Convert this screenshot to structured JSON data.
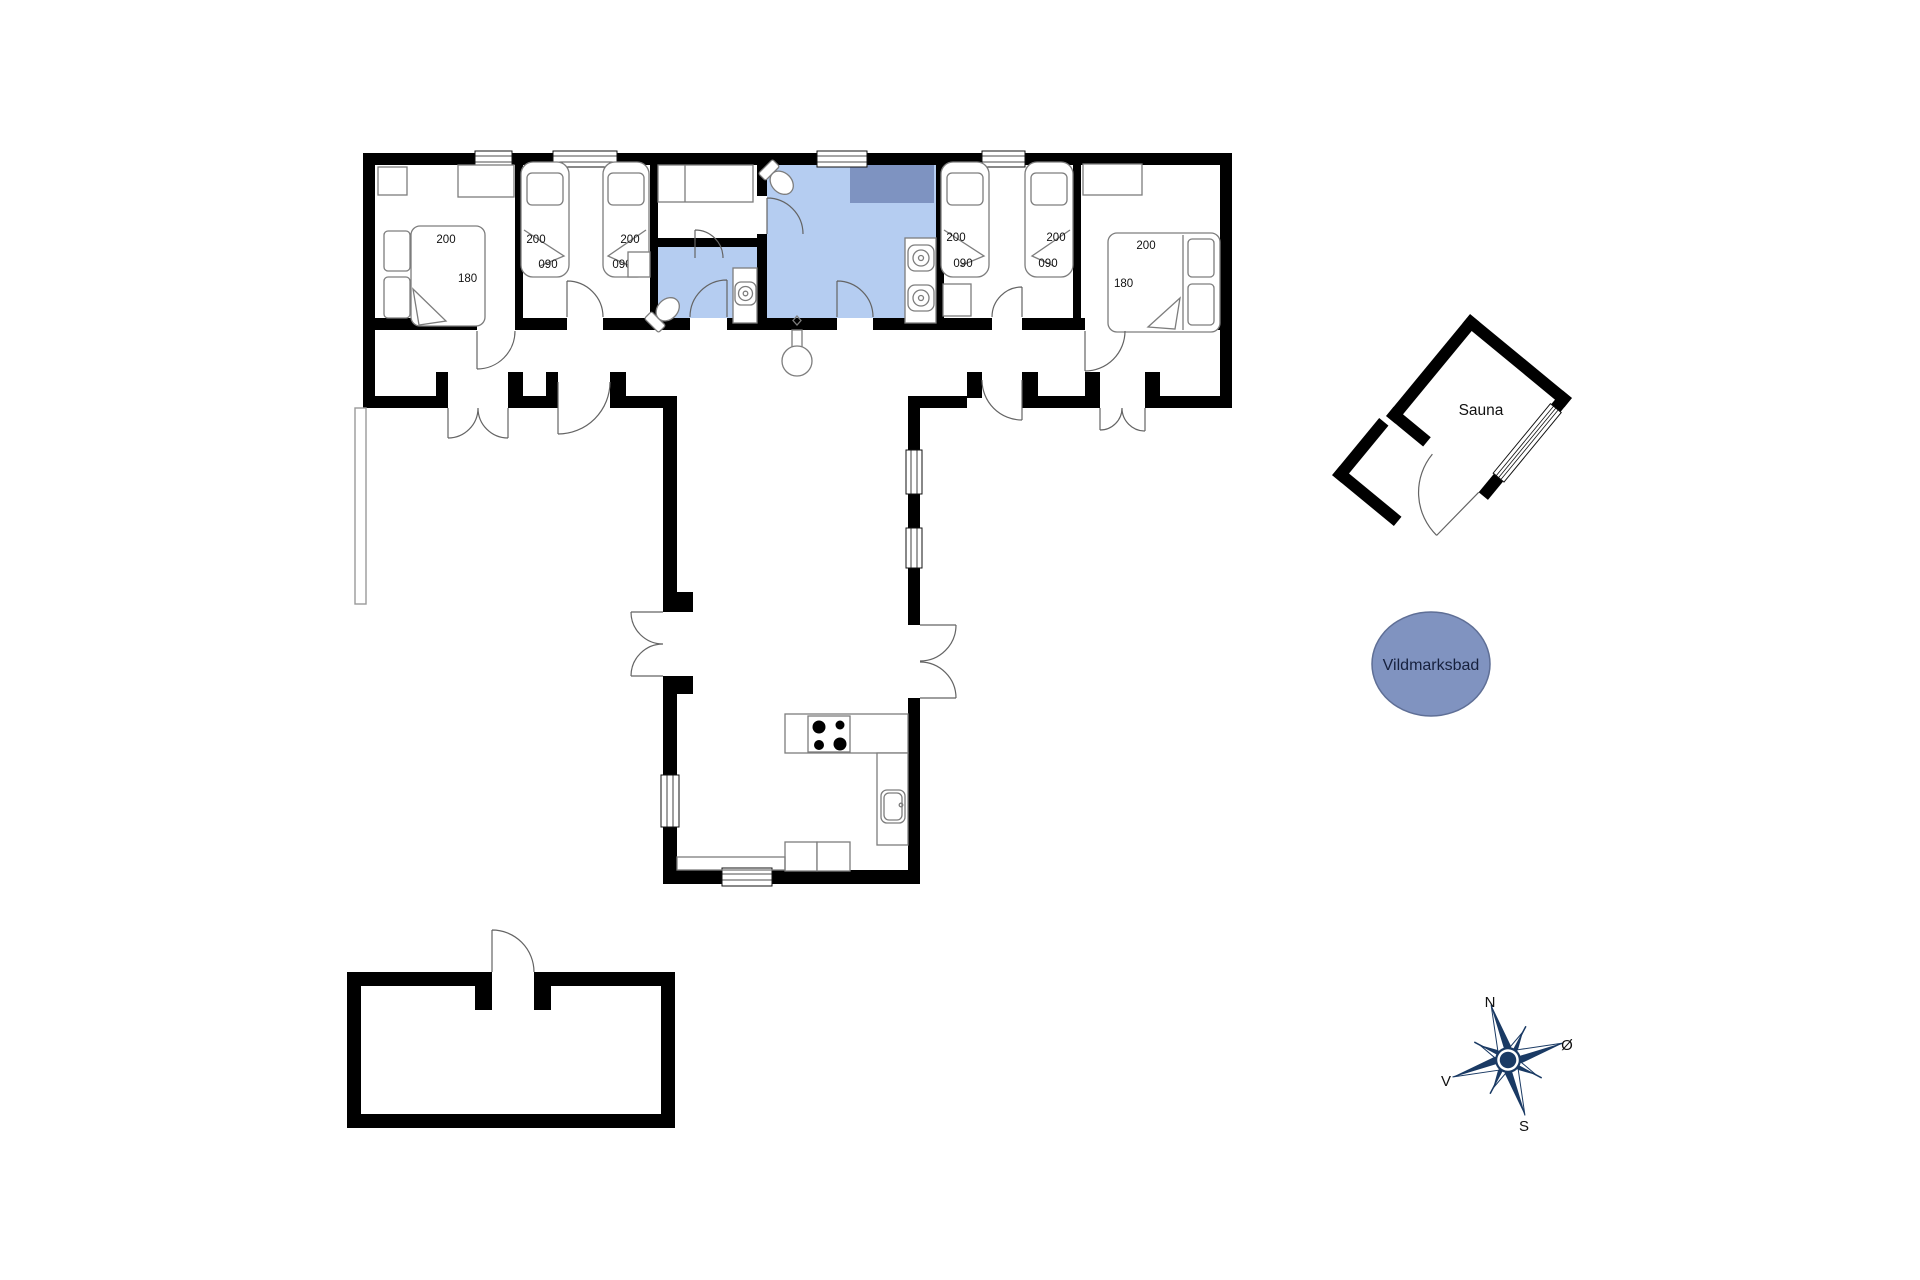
{
  "labels": {
    "bm1_200": "200",
    "bm1_180": "180",
    "twinL_a_200": "200",
    "twinL_a_090": "090",
    "twinL_b_200": "200",
    "twinL_b_090": "090",
    "twinR_a_200": "200",
    "twinR_a_090": "090",
    "twinR_b_200": "200",
    "twinR_b_090": "090",
    "bm6_200": "200",
    "bm6_180": "180",
    "sauna": "Sauna",
    "vildmarksbad": "Vildmarksbad",
    "compass_n": "N",
    "compass_e": "Ø",
    "compass_s": "S",
    "compass_w": "V"
  },
  "colors": {
    "wall": "#000000",
    "bath_fill": "#b5cdf1",
    "shower_fill": "#7e93c1",
    "hot_tub_fill": "#8093c0",
    "hot_tub_stroke": "#5f6f96",
    "compass": "#1a3a64"
  }
}
